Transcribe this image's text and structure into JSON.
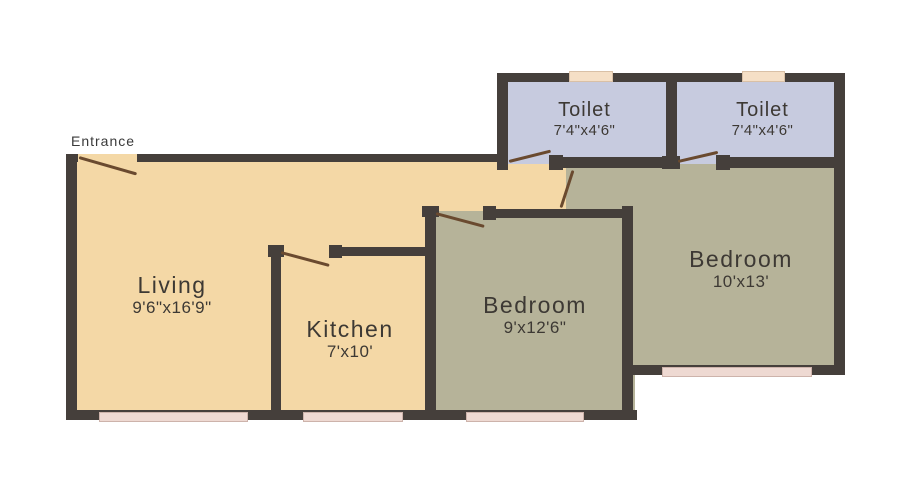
{
  "plan_title": "2BHK floor plan",
  "entrance_label": "Entrance",
  "rooms": {
    "living": {
      "name": "Living",
      "dims": "9'6\"x16'9\""
    },
    "kitchen": {
      "name": "Kitchen",
      "dims": "7'x10'"
    },
    "bedroom1": {
      "name": "Bedroom",
      "dims": "9'x12'6\""
    },
    "bedroom2": {
      "name": "Bedroom",
      "dims": "10'x13'"
    },
    "toilet1": {
      "name": "Toilet",
      "dims": "7'4\"x4'6\""
    },
    "toilet2": {
      "name": "Toilet",
      "dims": "7'4\"x4'6\""
    }
  },
  "colors": {
    "floor_living": "#f4d8a6",
    "floor_bedroom": "#b6b399",
    "floor_toilet": "#c7cbdf",
    "wall": "#453f3b",
    "window_top": "#f5dfc6",
    "window_bottom": "#eed9d2",
    "door": "#6a4a2f",
    "label": "#3d3934"
  }
}
